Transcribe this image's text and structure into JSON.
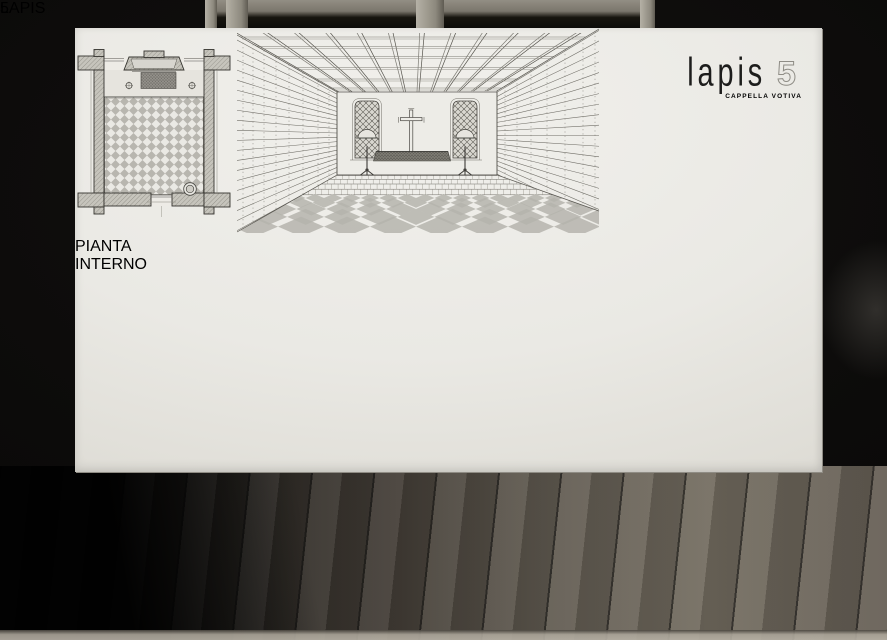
{
  "board": {
    "logo": {
      "brand": "lapis",
      "number": "5",
      "subtitle": "CAPPELLA VOTIVA"
    },
    "drawings": [
      {
        "label": "PIANTA"
      },
      {
        "label": "INTERNO"
      }
    ]
  },
  "cards": {
    "left": "LAPIS",
    "right": "5"
  },
  "colors": {
    "background": "#0b0a09",
    "board": "#eae9e4",
    "drawing_ink": "#4a4843",
    "drawing_texture": "#6f6d66",
    "wood_light": "#b7b2a6",
    "wood_dark": "#514d46",
    "card": "#f4f3ef"
  }
}
